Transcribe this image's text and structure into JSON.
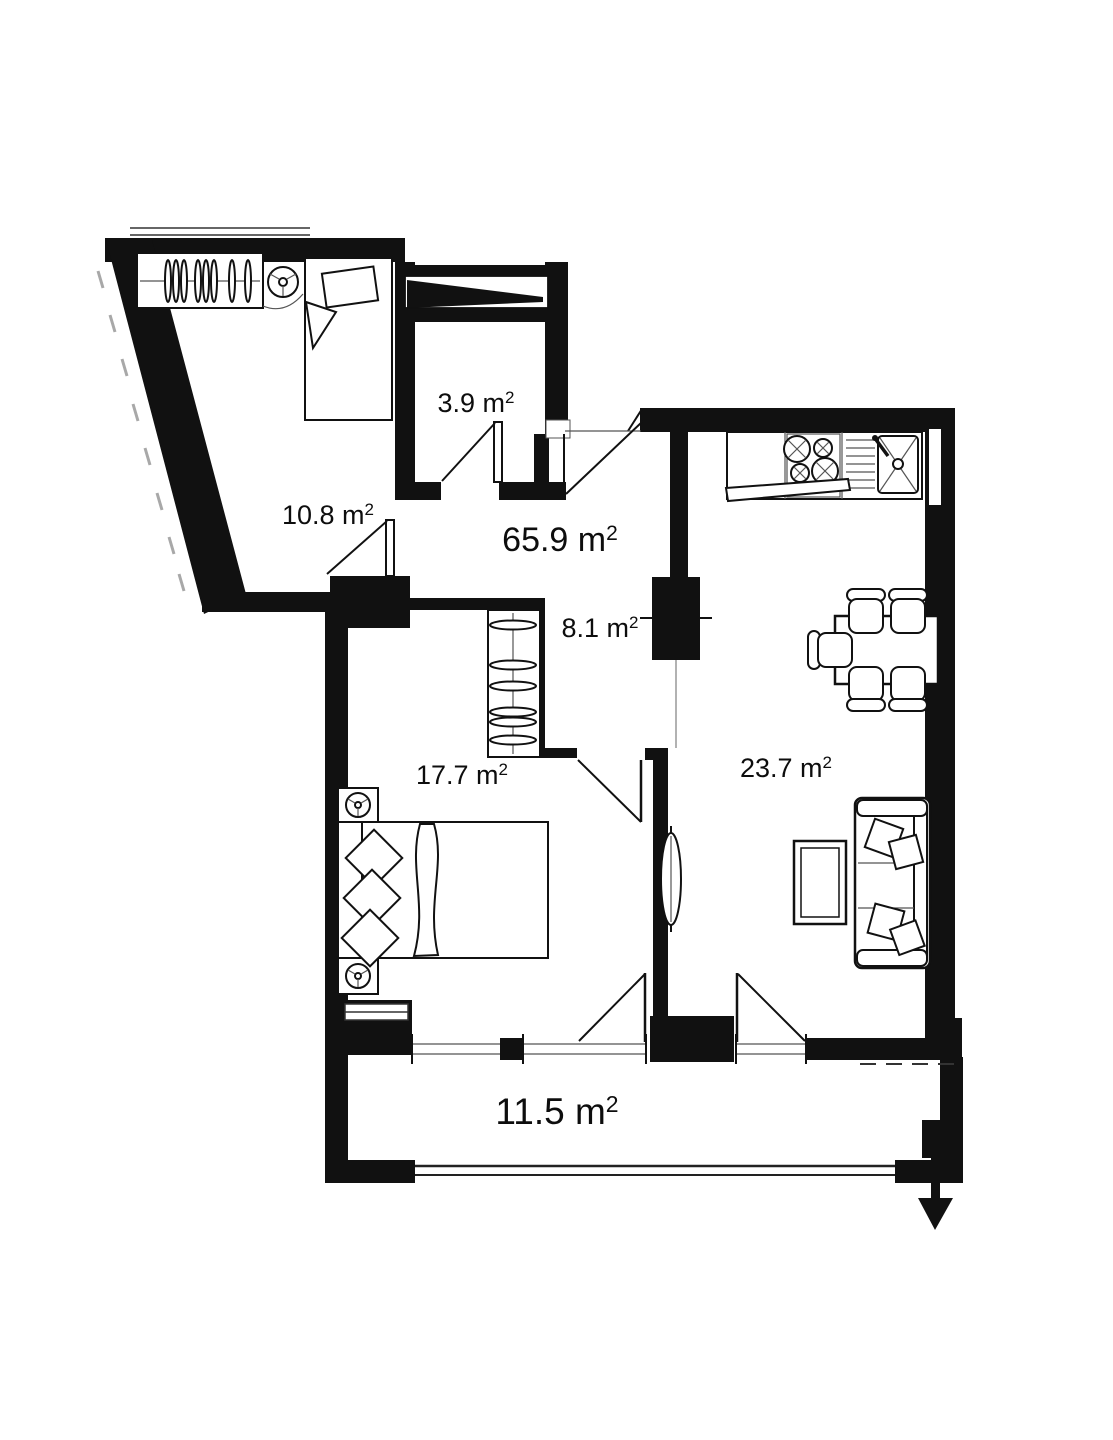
{
  "plan": {
    "type": "apartment-floor-plan",
    "palette": {
      "walls": "#111111",
      "background": "#ffffff",
      "thin_lines": "#333333"
    },
    "rooms": [
      {
        "key": "entry-storage",
        "label": "3.9 m",
        "sup": "2"
      },
      {
        "key": "bedroom-small",
        "label": "10.8 m",
        "sup": "2"
      },
      {
        "key": "total-area",
        "label": "65.9 m",
        "sup": "2"
      },
      {
        "key": "hallway",
        "label": "8.1 m",
        "sup": "2"
      },
      {
        "key": "bedroom-main",
        "label": "17.7 m",
        "sup": "2"
      },
      {
        "key": "living-room",
        "label": "23.7 m",
        "sup": "2"
      },
      {
        "key": "balcony",
        "label": "11.5 m",
        "sup": "2"
      }
    ]
  }
}
